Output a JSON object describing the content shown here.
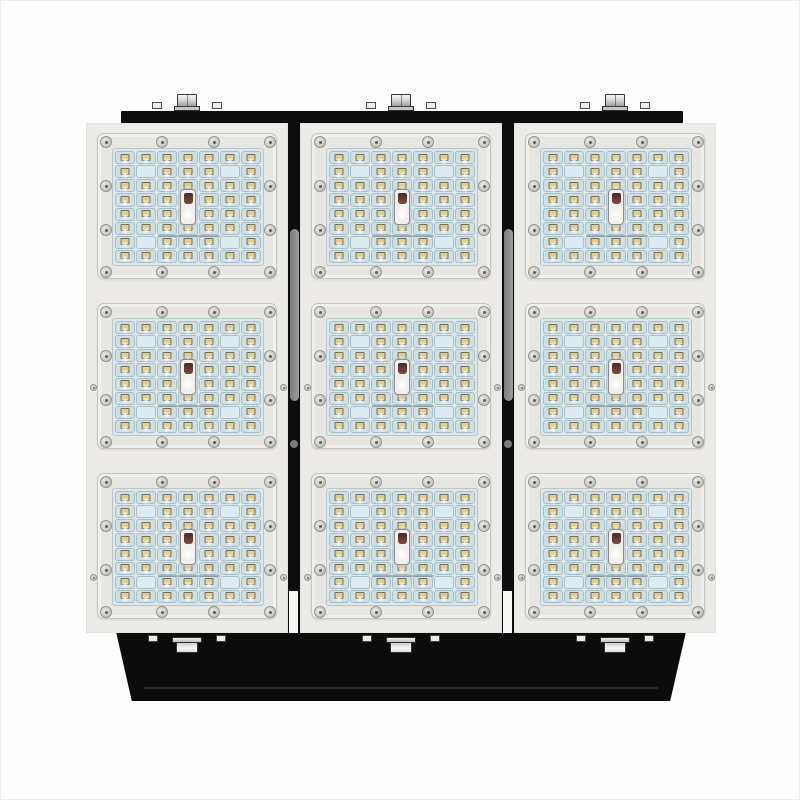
{
  "meta": {
    "type": "product-photo",
    "subject": "industrial LED floodlight, front view, on white background"
  },
  "fixture": {
    "panels": 3,
    "modules_per_panel": 3,
    "lens_rows": 8,
    "lens_columns": 7,
    "blank_lens_cells": [
      [
        2,
        2
      ],
      [
        2,
        6
      ],
      [
        7,
        2
      ],
      [
        7,
        6
      ]
    ],
    "frame_screws_per_module": 12,
    "top_mount_bolts": 3,
    "base_bolts": 3,
    "gap_heatsink_fins": 2,
    "module_print_marking": "illegible-fine-print"
  },
  "colors": {
    "background": "#fdfdfd",
    "panel": "#edebe7",
    "module-frame": "#e7e6e2",
    "module-border": "#c6c5c0",
    "lens-plate": "#dbe7ea",
    "lens-cell": "#cfe0e5",
    "lens-border": "#a9bfc6",
    "led-chip": "#e2cd90",
    "screw": "#d3d2ce",
    "screw-ring": "#95948f",
    "black": "#0d0d0d",
    "heatsink-gray": "#8f8f8f",
    "connector-maroon": "#6e4037"
  }
}
